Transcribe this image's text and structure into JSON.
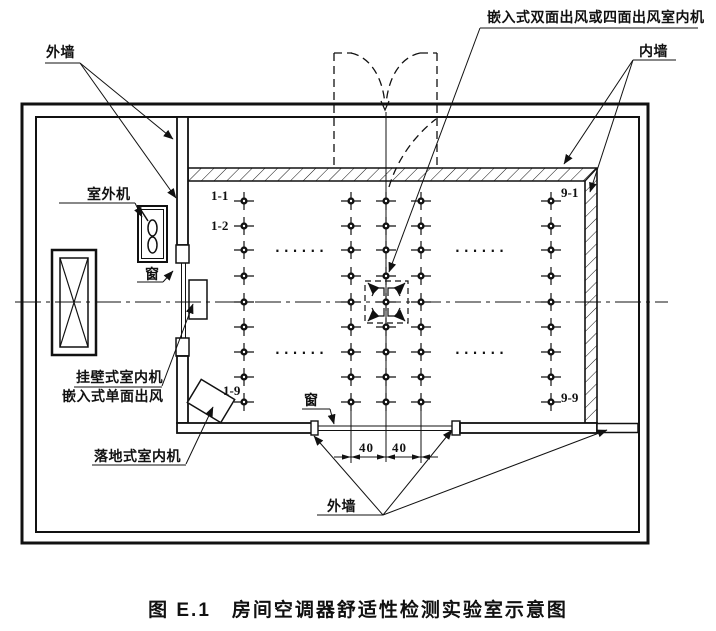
{
  "figure": {
    "title": "图 E.1　房间空调器舒适性检测实验室示意图"
  },
  "labels": {
    "outer_wall_top": "外墙",
    "outer_wall_bottom": "外墙",
    "inner_wall": "内墙",
    "outdoor_unit": "室外机",
    "window_left": "窗",
    "window_bottom": "窗",
    "wall_mounted_indoor_unit": "挂壁式室内机",
    "embedded_single_outlet": "嵌入式单面出风",
    "floor_standing_indoor_unit": "落地式室内机",
    "embedded_cassette_unit": "嵌入式双面出风或四面出风室内机"
  },
  "grid_labels": {
    "row1_col1": "1-1",
    "row2_col1": "1-2",
    "row9_col1": "1-9",
    "row1_col9": "9-1",
    "row9_col9": "9-9",
    "ellipsis": "......"
  },
  "dimensions": {
    "left": "40",
    "right": "40"
  },
  "grid": {
    "rows_y": [
      201,
      226,
      250,
      276,
      302,
      327,
      352,
      377,
      402
    ],
    "cols_x": [
      244,
      351,
      386,
      421,
      551
    ]
  },
  "colors": {
    "line": "#111111",
    "background": "#ffffff"
  }
}
